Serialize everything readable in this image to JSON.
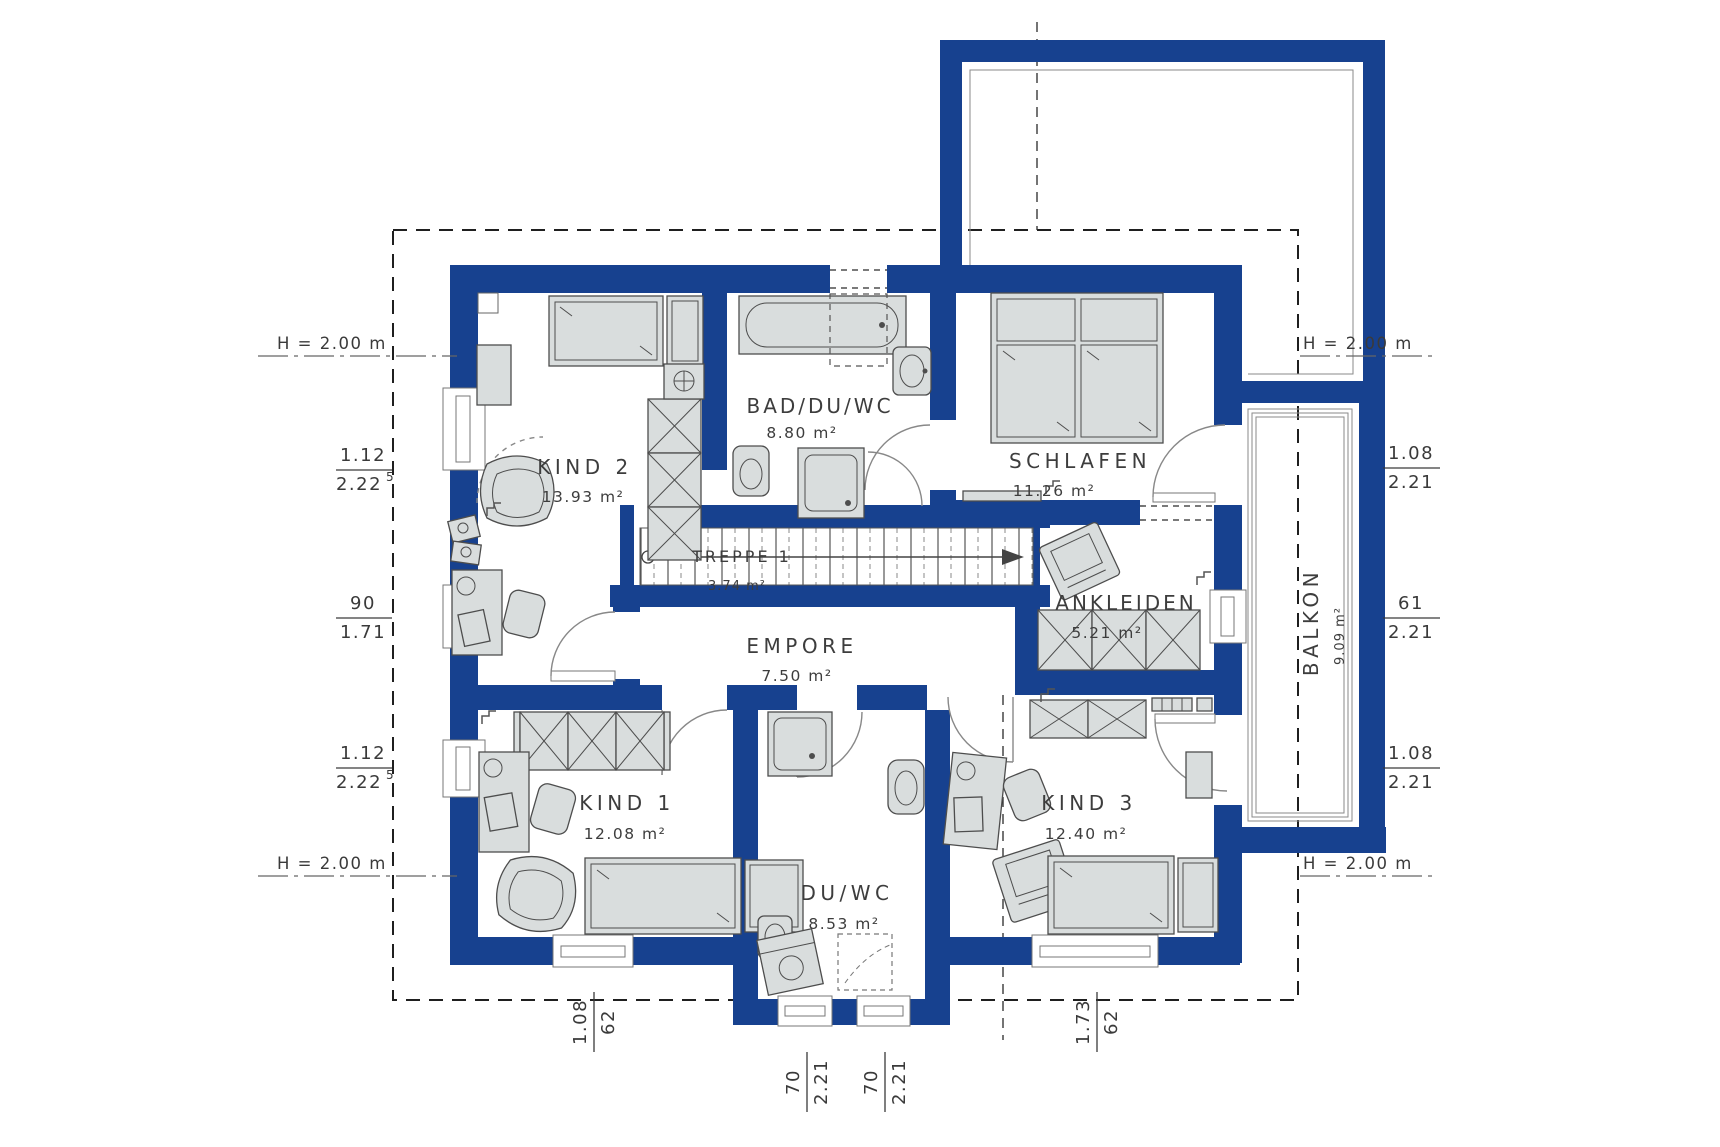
{
  "plan": {
    "title": "Obergeschoss Grundriss",
    "rooms": [
      {
        "id": "kind2",
        "name": "KIND 2",
        "area": "13.93 m²"
      },
      {
        "id": "bad-du-wc",
        "name": "BAD/DU/WC",
        "area": "8.80 m²"
      },
      {
        "id": "schlafen",
        "name": "SCHLAFEN",
        "area": "11.26 m²"
      },
      {
        "id": "treppe-1",
        "name": "TREPPE 1",
        "area": "3.74 m²"
      },
      {
        "id": "empore",
        "name": "EMPORE",
        "area": "7.50 m²"
      },
      {
        "id": "ankleiden",
        "name": "ANKLEIDEN",
        "area": "5.21 m²"
      },
      {
        "id": "balkon",
        "name": "BALKON",
        "area": "9.09 m²"
      },
      {
        "id": "kind1",
        "name": "KIND 1",
        "area": "12.08 m²"
      },
      {
        "id": "du-wc",
        "name": "DU/WC",
        "area": "8.53 m²"
      },
      {
        "id": "kind3",
        "name": "KIND 3",
        "area": "12.40 m²"
      }
    ],
    "height_markers": [
      "H = 2.00 m",
      "H = 2.00 m",
      "H = 2.00 m",
      "H = 2.00 m"
    ],
    "dimensions": {
      "left": [
        {
          "top": "1.12",
          "bottom": "2.22",
          "sup": "5"
        },
        {
          "top": "90",
          "bottom": "1.71"
        },
        {
          "top": "1.12",
          "bottom": "2.22",
          "sup": "5"
        }
      ],
      "right": [
        {
          "top": "1.08",
          "bottom": "2.21"
        },
        {
          "top": "61",
          "bottom": "2.21"
        },
        {
          "top": "1.08",
          "bottom": "2.21"
        }
      ],
      "bottom": [
        {
          "top": "1.08",
          "bottom": "62"
        },
        {
          "top": "70",
          "bottom": "2.21"
        },
        {
          "top": "70",
          "bottom": "2.21"
        },
        {
          "top": "1.73",
          "bottom": "62"
        }
      ]
    },
    "colors": {
      "wall_blue": "#17418f",
      "furniture_fill": "#d9dddd",
      "outline": "#4d4d4d",
      "text": "#3d3d3d",
      "background": "#ffffff"
    }
  }
}
